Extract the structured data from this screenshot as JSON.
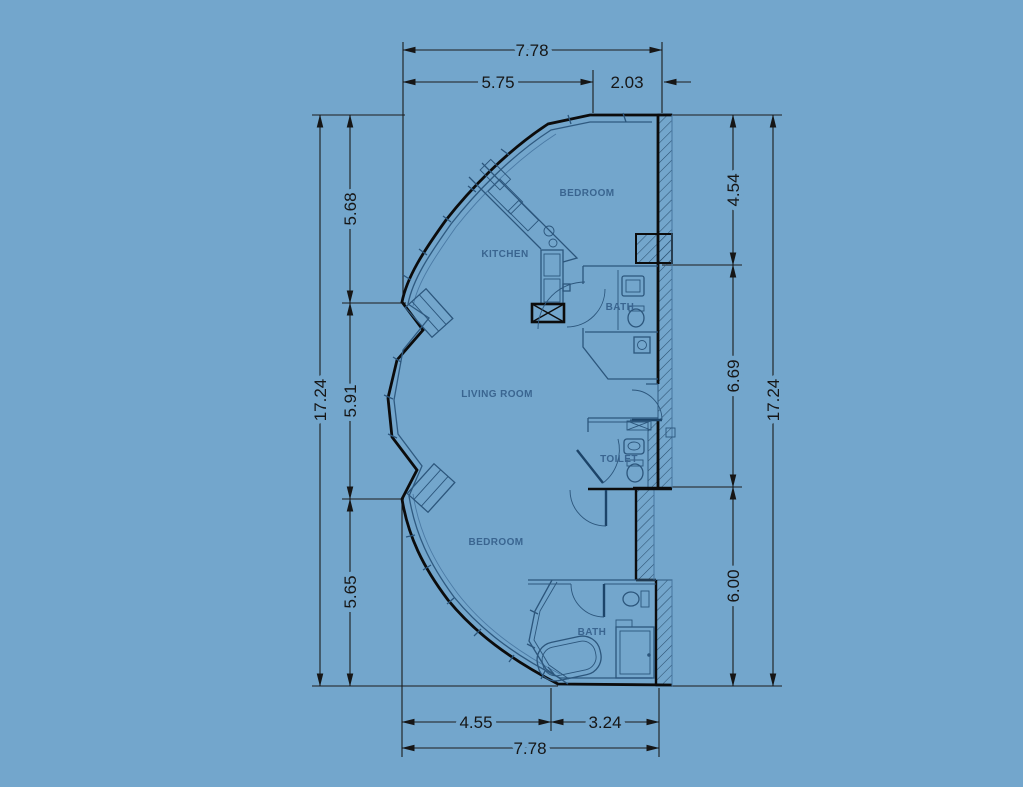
{
  "drawing": {
    "type": "apartment floor plan",
    "units_note": "dimensions as printed on drawing"
  },
  "colors": {
    "background": "#73a6cc",
    "wall_line": "#0c0c0c",
    "detail_line": "#2f5a80",
    "room_label": "#3a6590",
    "dimension_text": "#161616"
  },
  "rooms": {
    "bedroom_top": "BEDROOM",
    "kitchen": "KITCHEN",
    "bath_middle": "BATH",
    "living_room": "LIVING ROOM",
    "toilet": "TOILET",
    "bedroom_bottom": "BEDROOM",
    "bath_bottom": "BATH"
  },
  "dimensions": {
    "top": {
      "overall": "7.78",
      "segment_left": "5.75",
      "segment_right": "2.03"
    },
    "bottom": {
      "segment_left": "4.55",
      "segment_right": "3.24",
      "overall": "7.78"
    },
    "left": {
      "overall": "17.24",
      "segments": [
        "5.68",
        "5.91",
        "5.65"
      ]
    },
    "right": {
      "overall": "17.24",
      "segments": [
        "4.54",
        "6.69",
        "6.00"
      ]
    }
  }
}
